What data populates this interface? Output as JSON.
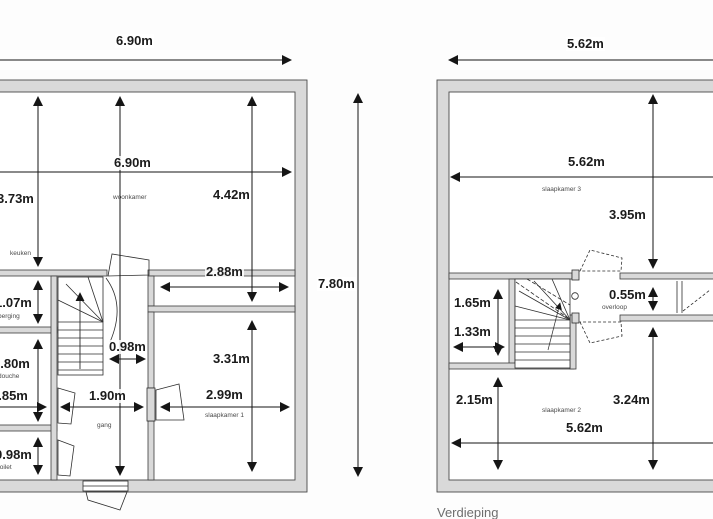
{
  "left": {
    "dims": {
      "top_width": "6.90m",
      "inner_width": "6.90m",
      "keuken_h": "3.73m",
      "woonkamer_h": "4.42m",
      "corridor_w": "2.88m",
      "total_h": "7.80m",
      "berging_h": "1.07m",
      "stair_gap_w": "0.98m",
      "douche_h": "1.80m",
      "douche_w": "1.85m",
      "gang_w": "1.90m",
      "toilet_h": "0.98m",
      "slaapkamer1_h": "3.31m",
      "slaapkamer1_w": "2.99m"
    },
    "rooms": {
      "woonkamer": "woonkamer",
      "keuken": "keuken",
      "berging": "berging",
      "douche": "douche",
      "gang": "gang",
      "toilet": "toilet",
      "slaapkamer1": "slaapkamer 1"
    }
  },
  "right": {
    "dims": {
      "top_width": "5.62m",
      "inner_width": "5.62m",
      "top_h": "3.95m",
      "closet_h": "1.65m",
      "closet_w": "1.33m",
      "overloop_h": "0.55m",
      "left_h": "2.15m",
      "slaapkamer2_h": "3.24m",
      "bottom_width": "5.62m"
    },
    "rooms": {
      "slaapkamer3": "slaapkamer 3",
      "slaapkamer2": "slaapkamer 2",
      "overloop": "overloop"
    },
    "caption": "Verdieping"
  }
}
